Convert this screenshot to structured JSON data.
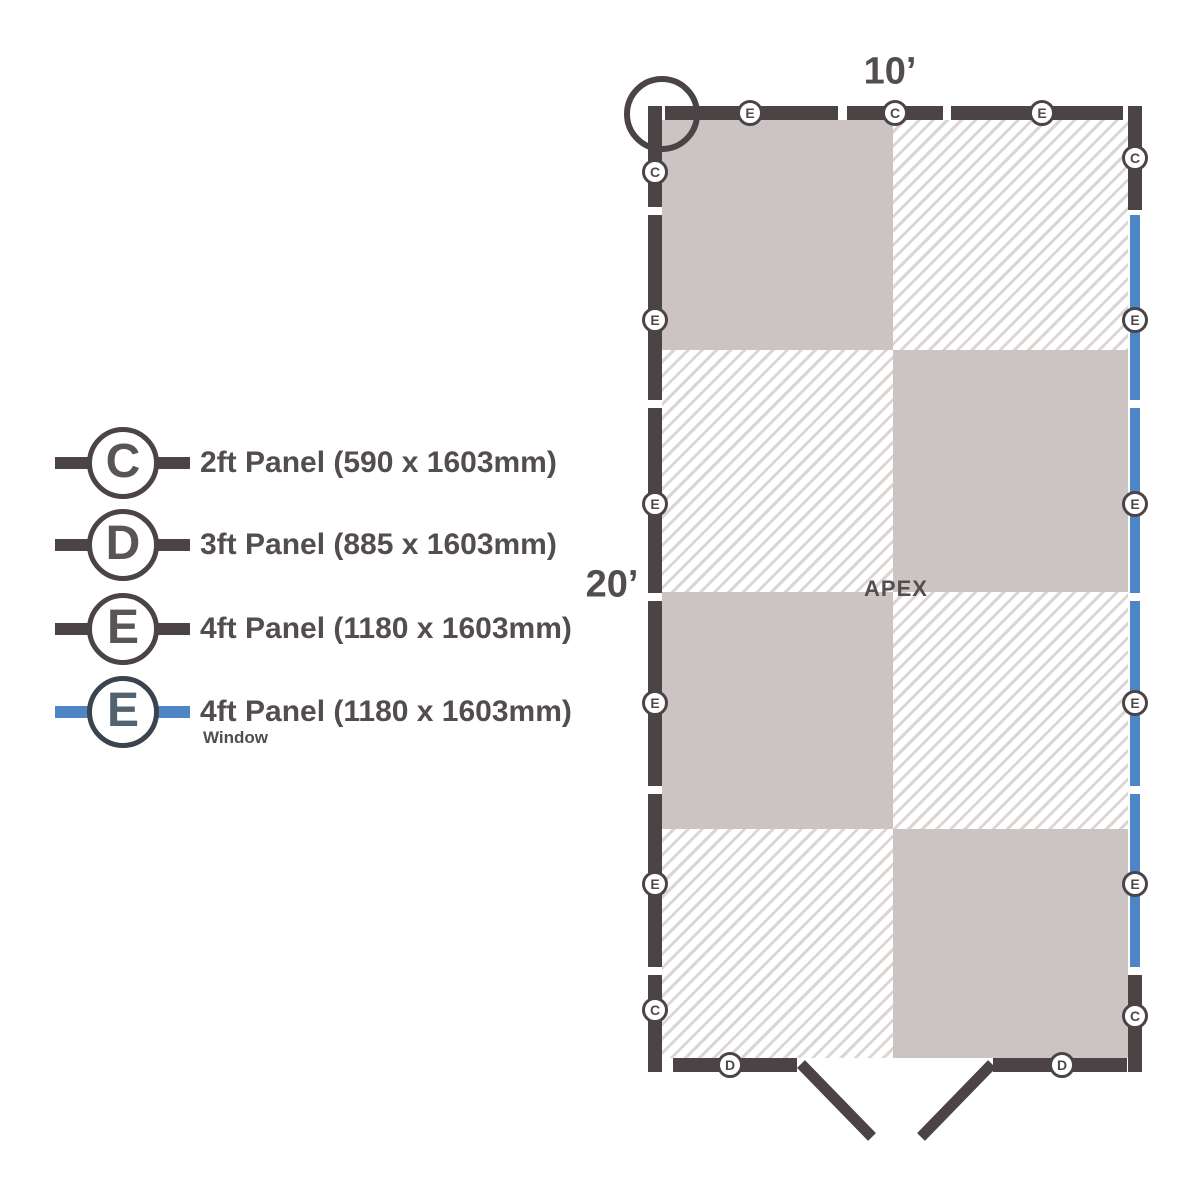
{
  "colors": {
    "background": "#ffffff",
    "wall_dark": "#4b4345",
    "floor_gray": "#cbc4c3",
    "hatch_line": "#dad6d4",
    "window_blue": "#4e86c5",
    "window_ring": "#3a434e",
    "window_letter": "#54616f",
    "text_dark": "#534d50",
    "legend_letter": "#5a5459",
    "marker_letter": "#4f484c"
  },
  "legend": {
    "rows": [
      {
        "letter": "C",
        "label": "2ft Panel (590 x 1603mm)"
      },
      {
        "letter": "D",
        "label": "3ft Panel (885 x 1603mm)"
      },
      {
        "letter": "E",
        "label": "4ft Panel (1180 x 1603mm)"
      },
      {
        "letter": "E",
        "label": "4ft Panel (1180 x 1603mm)",
        "sublabel": "Window",
        "window": true
      }
    ]
  },
  "plan": {
    "width_label": "10’",
    "height_label": "20’",
    "apex_label": "APEX",
    "wall_thickness": 14,
    "floor": {
      "row_bounds": [
        120,
        350,
        592,
        829,
        1058
      ],
      "col_bounds": [
        662,
        893,
        1128
      ],
      "pattern": [
        [
          "solid",
          "hatch"
        ],
        [
          "hatch",
          "solid"
        ],
        [
          "solid",
          "hatch"
        ],
        [
          "hatch",
          "solid"
        ]
      ]
    },
    "walls": {
      "left": {
        "x": 648,
        "dir": "v",
        "segments": [
          [
            106,
            207
          ],
          [
            215,
            400
          ],
          [
            408,
            593
          ],
          [
            601,
            786
          ],
          [
            794,
            967
          ],
          [
            975,
            1072
          ]
        ],
        "types": [
          "panel",
          "panel",
          "panel",
          "panel",
          "panel",
          "panel"
        ]
      },
      "right": {
        "x": 1128,
        "dir": "v",
        "segments": [
          [
            106,
            210
          ],
          [
            215,
            400
          ],
          [
            408,
            593
          ],
          [
            601,
            786
          ],
          [
            794,
            967
          ],
          [
            975,
            1072
          ]
        ],
        "types": [
          "panel",
          "window",
          "window",
          "window",
          "window",
          "panel"
        ]
      },
      "top": {
        "y": 106,
        "dir": "h",
        "segments": [
          [
            665,
            838
          ],
          [
            847,
            943
          ],
          [
            951,
            1123
          ]
        ],
        "types": [
          "panel",
          "panel",
          "panel"
        ]
      },
      "bottom": {
        "y": 1058,
        "dir": "h",
        "segments": [
          [
            673,
            797
          ],
          [
            993,
            1127
          ]
        ],
        "types": [
          "panel",
          "panel"
        ]
      }
    },
    "markers": {
      "left": {
        "x": 655,
        "items": [
          {
            "letter": "C",
            "y": 172
          },
          {
            "letter": "E",
            "y": 320
          },
          {
            "letter": "E",
            "y": 504
          },
          {
            "letter": "E",
            "y": 703
          },
          {
            "letter": "E",
            "y": 884
          },
          {
            "letter": "C",
            "y": 1010
          }
        ]
      },
      "right": {
        "x": 1135,
        "items": [
          {
            "letter": "C",
            "y": 158
          },
          {
            "letter": "E",
            "y": 320
          },
          {
            "letter": "E",
            "y": 504
          },
          {
            "letter": "E",
            "y": 703
          },
          {
            "letter": "E",
            "y": 884
          },
          {
            "letter": "C",
            "y": 1016
          }
        ]
      },
      "top": {
        "y": 113,
        "items": [
          {
            "letter": "E",
            "x": 750
          },
          {
            "letter": "C",
            "x": 895
          },
          {
            "letter": "E",
            "x": 1042
          }
        ]
      },
      "bottom": {
        "y": 1065,
        "items": [
          {
            "letter": "D",
            "x": 730
          },
          {
            "letter": "D",
            "x": 1062
          }
        ]
      }
    },
    "door": {
      "panels": [
        [
          801,
          1064,
          872,
          1137
        ],
        [
          921,
          1137,
          992,
          1064
        ]
      ]
    },
    "corner_circle": {
      "cx": 662,
      "cy": 114,
      "r": 38
    }
  }
}
